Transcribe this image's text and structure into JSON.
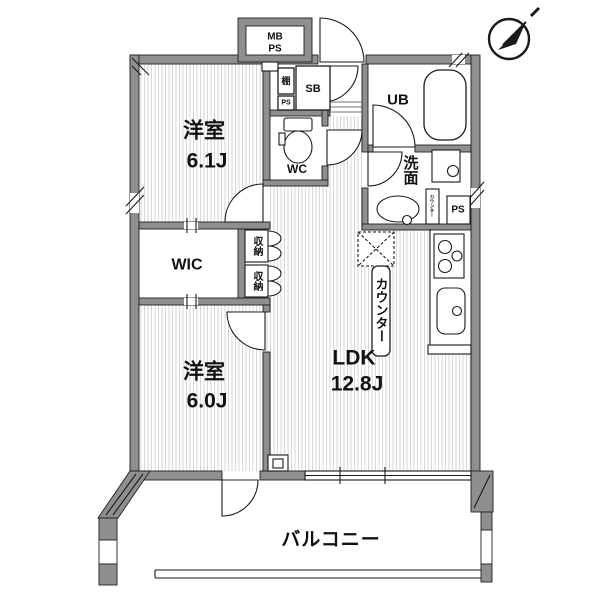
{
  "plan": {
    "rooms": {
      "bedroom_upper": {
        "name": "洋室",
        "size": "6.1J"
      },
      "bedroom_lower": {
        "name": "洋室",
        "size": "6.0J"
      },
      "ldk": {
        "name": "LDK",
        "size": "12.8J"
      },
      "wic": {
        "label": "WIC"
      },
      "toilet": {
        "label": "WC"
      },
      "unit_bath": {
        "label": "UB"
      },
      "washroom": {
        "label": "洗面"
      },
      "balcony": {
        "label": "バルコニー"
      }
    },
    "fixtures": {
      "meter_box_line1": "MB",
      "meter_box_line2": "PS",
      "shoe_box": "SB",
      "shelf": "棚",
      "pipe_space_top": "PS",
      "pipe_space_side": "PS",
      "storage_upper": "収納",
      "storage_lower": "収納",
      "kitchen_counter": "カウンター",
      "laundry_counter": "カウンター"
    },
    "colors": {
      "wall": "#8f8f8f",
      "line": "#1a1a1a",
      "floor_hatch": "#d7d7d7",
      "background": "#ffffff"
    },
    "icons": {
      "compass": "north-arrow"
    }
  }
}
